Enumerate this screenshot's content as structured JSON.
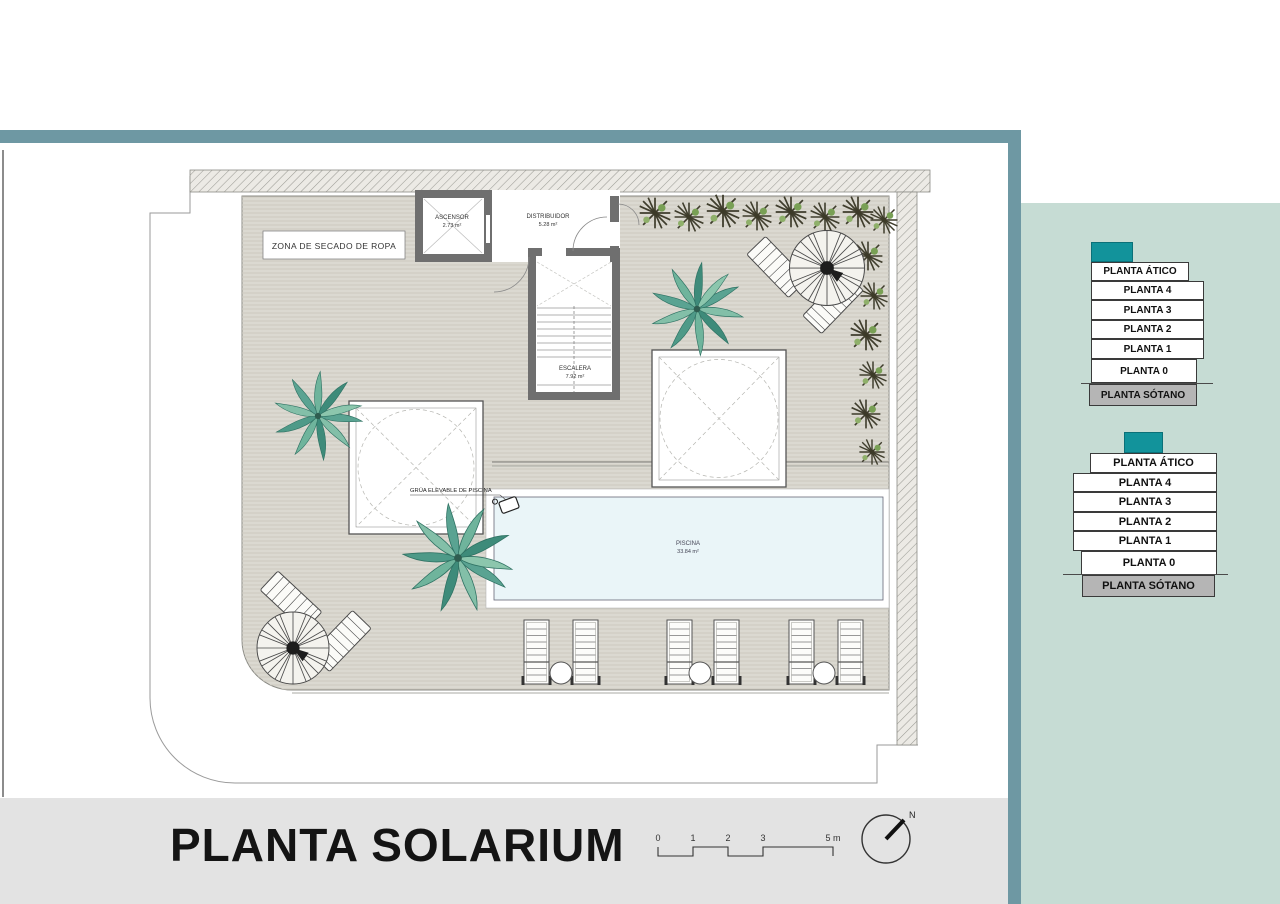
{
  "plan": {
    "rooms": {
      "ascensor": {
        "name": "ASCENSOR",
        "area": "2.73 m²"
      },
      "distribuidor": {
        "name": "DISTRIBUIDOR",
        "area": "5.28 m²"
      },
      "escalera": {
        "name": "ESCALERA",
        "area": "7.92 m²"
      },
      "piscina": {
        "name": "PISCINA",
        "area": "33.84 m²"
      }
    },
    "labels": {
      "zona_secado": "ZONA DE SECADO DE ROPA",
      "grua": "GRÚA ELEVABLE DE PISCINA"
    }
  },
  "footer": {
    "title": "PLANTA SOLARIUM",
    "scale_ticks": [
      "0",
      "1",
      "2",
      "3",
      "5 m"
    ],
    "north_label": "N"
  },
  "sidebar": {
    "stacks": [
      {
        "levels": [
          "PLANTA ÁTICO",
          "PLANTA 4",
          "PLANTA 3",
          "PLANTA 2",
          "PLANTA 1",
          "PLANTA 0",
          "PLANTA SÓTANO"
        ]
      },
      {
        "levels": [
          "PLANTA ÁTICO",
          "PLANTA 4",
          "PLANTA 3",
          "PLANTA 2",
          "PLANTA 1",
          "PLANTA 0",
          "PLANTA SÓTANO"
        ]
      }
    ]
  },
  "colors": {
    "accent_teal": "#6E98A3",
    "sidebar_bg": "#C6DCD4",
    "stack_teal": "#12939B",
    "basement_gray": "#B5B5B5",
    "deck": "#DBD9D1",
    "pool": "#EAF5F8"
  }
}
